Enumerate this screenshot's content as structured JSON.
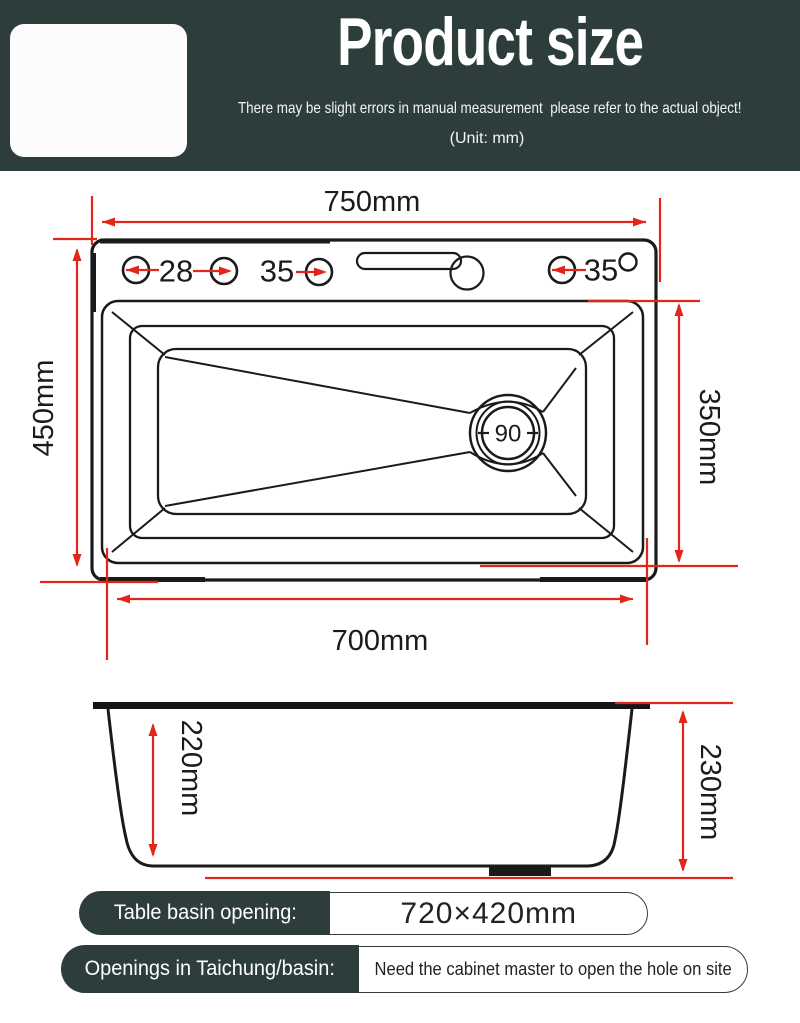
{
  "header": {
    "title": "Product size",
    "subtitle": "There may be slight errors in manual measurement  please refer to the actual object!",
    "unit_note": "(Unit: mm)",
    "background_color": "#2c3d3b",
    "text_color": "#ffffff"
  },
  "diagram": {
    "accent_red": "#e3261a",
    "line_color": "#1a1a1a",
    "top_view": {
      "overall_width": "750mm",
      "overall_depth": "450mm",
      "basin_depth": "350mm",
      "bottom_width": "700mm",
      "drain_diameter": "90",
      "hole_left": "28",
      "hole_mid": "35",
      "hole_right": "35"
    },
    "side_view": {
      "inner_height": "220mm",
      "overall_height": "230mm"
    }
  },
  "footer": {
    "rows": [
      {
        "label": "Table basin opening:",
        "value": "720×420mm"
      },
      {
        "label": "Openings in Taichung/basin:",
        "value": "Need the cabinet master to open the hole on site"
      }
    ]
  }
}
